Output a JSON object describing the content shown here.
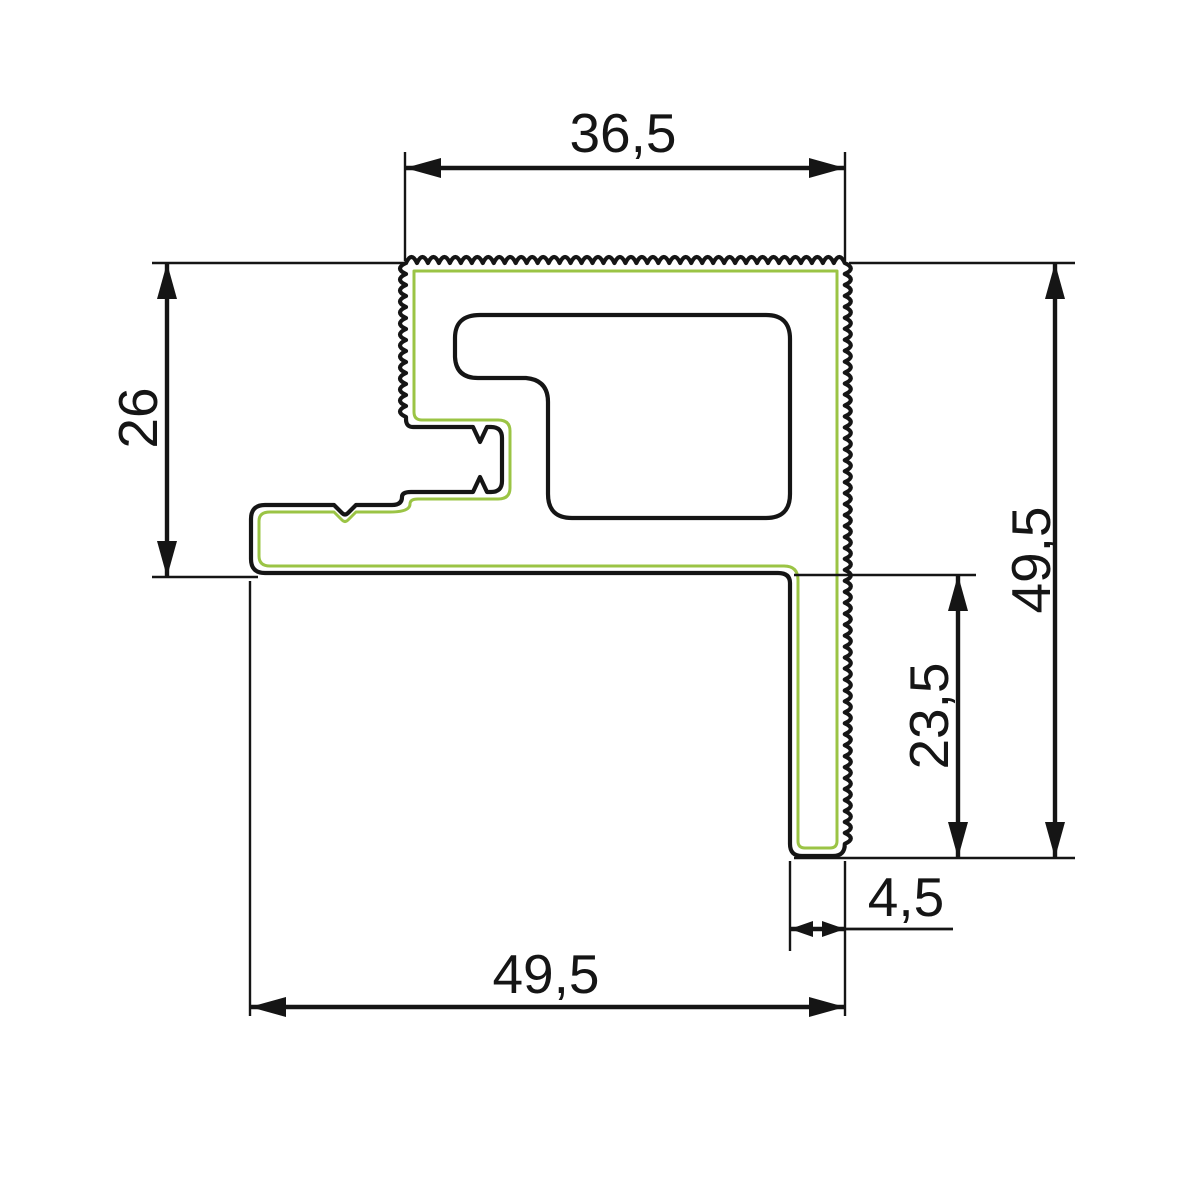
{
  "drawing": {
    "description": "aluminium-profile-cross-section-technical-drawing",
    "colors": {
      "background": "#ffffff",
      "outline": "#151515",
      "accent_green": "#9bc445",
      "dimension": "#151515"
    },
    "profile": {
      "outer_template": "M 406 263 {top} {right} Q 845 856 833 856 L 802 856 Q 790 856 790 844 L 790 583 Q 790 573 778 573 L 265 573 Q 251 573 251 559 L 251 519 Q 251 505 265 505 L 334 505 L 342 513 Q 345 516 348 513 L 356 505 L 392 505 Q 402 505 402 497 Q 402 492 411 492 L 473 492 L 480 477 L 487 492 L 491 492 Q 502 492 502 481 L 502 438 Q 502 427 491 427 L 487 427 L 480 442 L 473 427 L 413 427 Q 406 427 406 419 L 406 417 {left} Z",
      "serrated_edges": {
        "top": [
          406,
          263,
          845,
          263
        ],
        "right": [
          845,
          263,
          845,
          844
        ],
        "left": [
          406,
          417,
          406,
          263
        ]
      },
      "serration": {
        "wavelength": 11,
        "amplitude": 6
      },
      "cavity_path": "M 480 315 L 766 315 Q 790 315 790 339 L 790 494 Q 790 518 766 518 L 572 518 Q 548 518 548 494 L 548 402 Q 548 380 526 378 L 478 378 Q 456 378 455 357 L 455 338 Q 455 315 480 315 Z",
      "accent_path": "M 414 271 L 837 271 L 837 841 Q 837 848 830 848 L 805 848 Q 798 848 798 841 L 798 580 Q 798 566 784 566 L 270 566 Q 259 566 259 556 L 259 521 Q 259 512 270 512 L 334 512 L 342 520 Q 345 523 348 520 L 356 512 L 390 512 Q 410 512 410 504 Q 410 499 418 499 L 498 499 Q 510 499 510 488 L 510 431 Q 510 420 498 420 L 422 420 Q 414 420 414 412 Z"
    },
    "arrow_styles": {
      "normal": {
        "length": 36,
        "half_width": 10
      },
      "small": {
        "length": 23,
        "half_width": 8
      }
    },
    "line_weights": {
      "profile": 4.2,
      "accent": 3,
      "dimension_line": 4.4,
      "extension_line": 2.4,
      "leader_line": 2.8
    },
    "label_font_size": 55,
    "dimensions": [
      {
        "id": "width-top",
        "value": "36,5",
        "orientation": "horizontal",
        "extensions": [
          [
            405,
            152,
            405,
            261
          ],
          [
            845,
            152,
            845,
            261
          ]
        ],
        "line": [
          405,
          168,
          845,
          168
        ],
        "arrow": "normal",
        "text": {
          "x": 623,
          "y": 152,
          "rotate": 0
        }
      },
      {
        "id": "height-left",
        "value": "26",
        "orientation": "vertical",
        "extensions": [
          [
            152,
            263,
            408,
            263
          ],
          [
            152,
            577,
            258,
            577
          ]
        ],
        "line": [
          167,
          263,
          167,
          577
        ],
        "arrow": "normal",
        "text": {
          "x": 157,
          "y": 418,
          "rotate": -90
        }
      },
      {
        "id": "height-right",
        "value": "49,5",
        "orientation": "vertical",
        "extensions": [
          [
            849,
            263,
            1075,
            263
          ],
          [
            794,
            858,
            1075,
            858
          ]
        ],
        "line": [
          1055,
          263,
          1055,
          858
        ],
        "arrow": "normal",
        "text": {
          "x": 1050,
          "y": 560,
          "rotate": -90
        }
      },
      {
        "id": "height-inner-right",
        "value": "23,5",
        "orientation": "vertical",
        "extensions": [
          [
            794,
            575,
            976,
            575
          ]
        ],
        "line": [
          958,
          575,
          958,
          858
        ],
        "arrow": "normal",
        "text": {
          "x": 948,
          "y": 716,
          "rotate": -90
        }
      },
      {
        "id": "width-leg",
        "value": "4,5",
        "orientation": "horizontal",
        "extensions": [
          [
            790,
            861,
            790,
            951
          ]
        ],
        "leader": [
          845,
          929,
          953,
          929
        ],
        "line": [
          790,
          929,
          845,
          929
        ],
        "arrow": "small",
        "text": {
          "x": 906,
          "y": 916,
          "rotate": 0
        }
      },
      {
        "id": "width-bottom",
        "value": "49,5",
        "orientation": "horizontal",
        "extensions": [
          [
            250,
            581,
            250,
            1016
          ],
          [
            845,
            861,
            845,
            1016
          ]
        ],
        "line": [
          250,
          1007,
          845,
          1007
        ],
        "arrow": "normal",
        "text": {
          "x": 546,
          "y": 993,
          "rotate": 0
        }
      }
    ]
  }
}
